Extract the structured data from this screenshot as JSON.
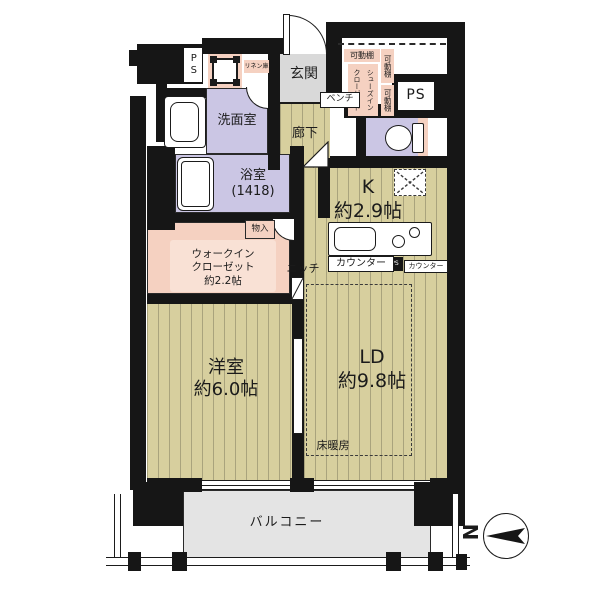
{
  "colors": {
    "wall": "#161616",
    "wood": "#d7cf9e",
    "wood_stripe": "#a9a37d",
    "lavender": "#cbc6e4",
    "pink": "#f5d1c1",
    "pink_light": "#f9e1d5",
    "genkan_gray": "#d9d9d9",
    "balcony_gray": "#e4e4e4"
  },
  "rooms": {
    "genkan": {
      "label": "玄関"
    },
    "rouka": {
      "label": "廊下"
    },
    "senmen": {
      "label": "洗面室"
    },
    "bath": {
      "label": "浴室",
      "size": "(1418)"
    },
    "wic": {
      "l1": "ウォークイン",
      "l2": "クローゼット",
      "size": "約2.2帖"
    },
    "monoire": {
      "label": "物入"
    },
    "youshitsu": {
      "label": "洋室",
      "size": "約6.0帖"
    },
    "ld": {
      "label": "LD",
      "size": "約9.8帖"
    },
    "kitchen": {
      "label": "K",
      "size": "約2.9帖"
    },
    "sic": {
      "label": "シューズイン\nクローゼット"
    },
    "balcony": {
      "label": "バルコニー"
    }
  },
  "labels": {
    "ps_upper_left": "PS",
    "ps_upper_right": "PS",
    "ps_counter": "PS",
    "kadou_top": "可動棚",
    "kadou_right_upper": "可動棚",
    "kadou_right_lower": "可動棚",
    "linen": "リネン庫",
    "bench": "ベンチ",
    "niche": "ニッチ",
    "counter": "カウンター",
    "counter_small": "カウンター",
    "floor_heating": "床暖房",
    "compass_north": "N"
  }
}
